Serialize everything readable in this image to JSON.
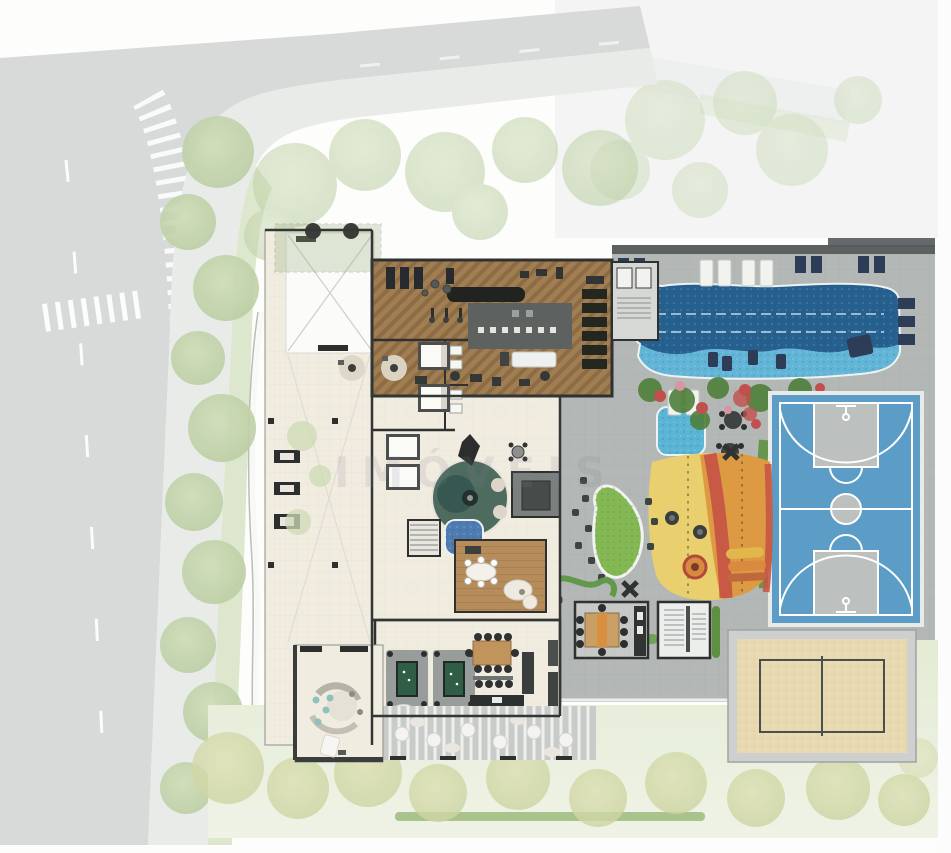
{
  "watermark": "IMÓVEIS",
  "colors": {
    "street": "#d7dad9",
    "sidewalk": "#e9ebe8",
    "lawn": "#e3ebd4",
    "deck": "#b3b7b5",
    "floor_cream": "#f1ece0",
    "wall_dark": "#333634",
    "gym_wood": "#a07e52",
    "gym_wood_dark": "#8d6c45",
    "room_wood": "#b78c5b",
    "pool_deep": "#26608f",
    "pool_shallow": "#62b5d6",
    "kids_pool": "#5ab4d4",
    "basketball_blue": "#5b9dc6",
    "court_gray": "#bcc0be",
    "sand": "#e8d9b0",
    "sand_frame": "#cdd0cf",
    "playground_yellow": "#e9cf6e",
    "playground_orange": "#dd9a42",
    "playground_red": "#c65545",
    "island_green": "#84b855",
    "hedge_green": "#5d9141",
    "flower_red": "#c0504d",
    "flower_pink": "#d894a0",
    "lounger_navy": "#2e3d57",
    "mosaic_blue": "#4f7cb0",
    "tree_green": "#b9cda2",
    "tree_yellow": "#ccd4a2"
  },
  "areas": [
    {
      "id": "street"
    },
    {
      "id": "crosswalk"
    },
    {
      "id": "sidewalk-trees"
    },
    {
      "id": "entrance-drive"
    },
    {
      "id": "lobby"
    },
    {
      "id": "green-roof"
    },
    {
      "id": "gym"
    },
    {
      "id": "locker-rooms"
    },
    {
      "id": "massage-rooms"
    },
    {
      "id": "lounge"
    },
    {
      "id": "sauna"
    },
    {
      "id": "spa-bath"
    },
    {
      "id": "reading-room"
    },
    {
      "id": "party-room"
    },
    {
      "id": "billiards"
    },
    {
      "id": "dining"
    },
    {
      "id": "kitchen"
    },
    {
      "id": "gourmet-bbq"
    },
    {
      "id": "stairwell"
    },
    {
      "id": "pergola"
    },
    {
      "id": "lap-pool"
    },
    {
      "id": "kids-pool"
    },
    {
      "id": "sun-deck"
    },
    {
      "id": "playground"
    },
    {
      "id": "garden-island"
    },
    {
      "id": "basketball-court"
    },
    {
      "id": "beach-volleyball-court"
    },
    {
      "id": "lawn"
    }
  ]
}
